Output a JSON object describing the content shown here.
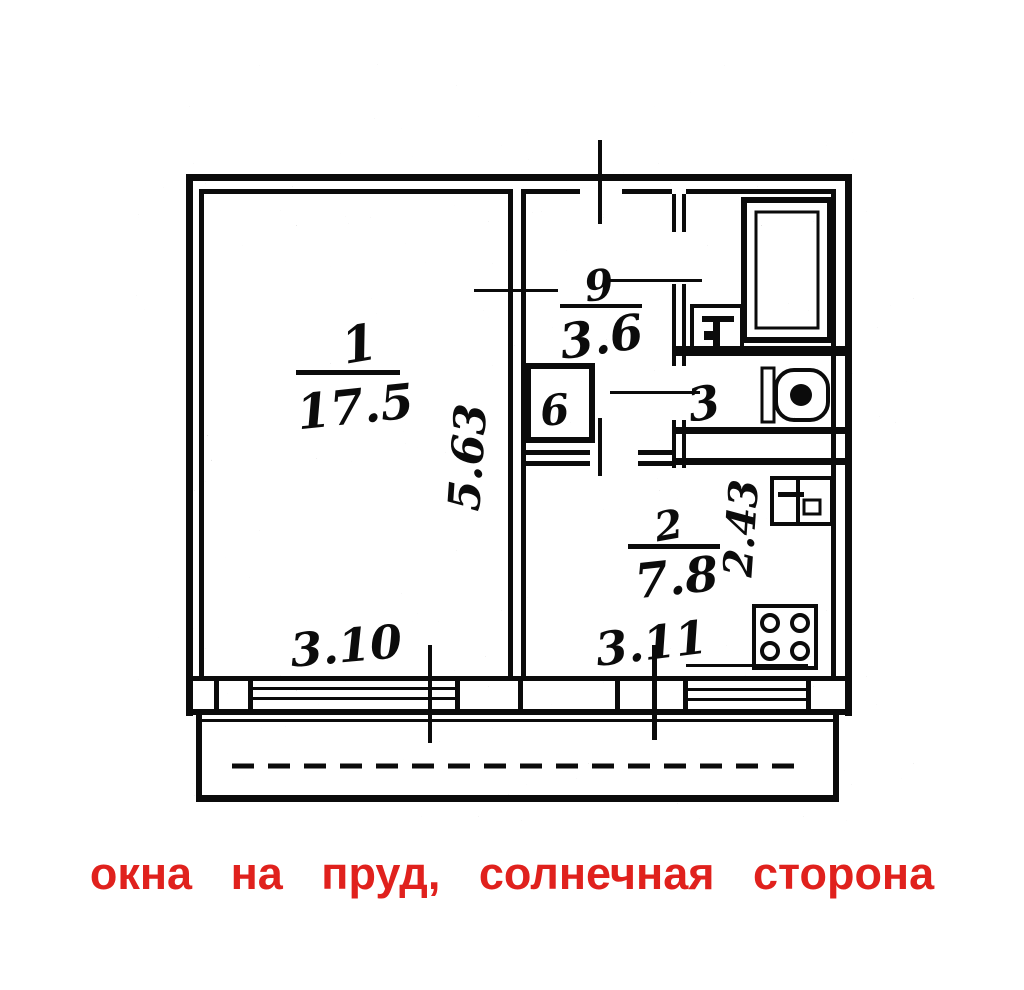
{
  "plan": {
    "title": "apartment floor plan (scanned BTI drawing)",
    "rooms": {
      "living": {
        "number": "1",
        "area": "17.5"
      },
      "hall": {
        "number": "9",
        "area": "3.6"
      },
      "closet": {
        "number": "6"
      },
      "wc": {
        "number": "3"
      },
      "kitchen": {
        "number": "2",
        "area": "7.8"
      }
    },
    "dimensions": {
      "living_width": "3.10",
      "living_depth": "5.63",
      "kitchen_width": "3.11",
      "kitchen_depth": "2.43"
    },
    "line_color": "#0b0b0b"
  },
  "caption": {
    "text": "окна на пруд, солнечная сторона",
    "color": "#e0211d"
  }
}
